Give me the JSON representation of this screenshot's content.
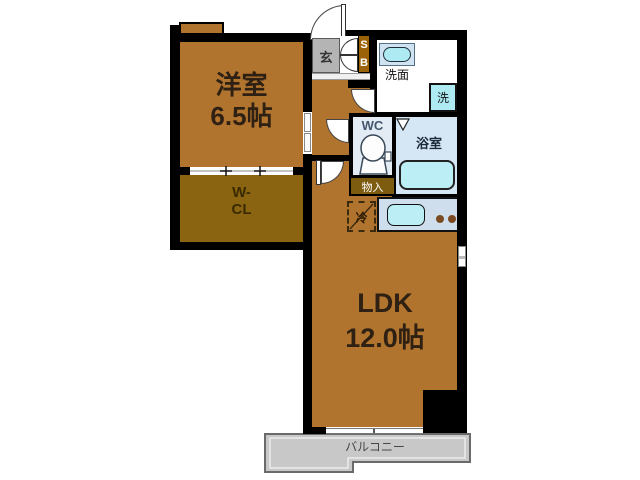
{
  "title": "apartment-floor-plan",
  "rooms": {
    "western": {
      "label": "洋室",
      "size": "6.5帖"
    },
    "wcl": {
      "line1": "W-",
      "line2": "CL"
    },
    "ldk": {
      "label": "LDK",
      "size": "12.0帖"
    },
    "genkan": {
      "label": "玄"
    },
    "shoebox": {
      "letters": [
        "S",
        "B"
      ]
    },
    "washroom": {
      "label": "洗面"
    },
    "washer": {
      "label": "洗"
    },
    "wc": {
      "label": "WC"
    },
    "bath": {
      "label": "浴室"
    },
    "storage": {
      "label": "物入"
    },
    "fridge": {
      "label": "冷"
    },
    "balcony": {
      "label": "バルコニー"
    }
  },
  "colors": {
    "wall": "#000000",
    "room_floor": "#b1742e",
    "closet_floor": "#8a6410",
    "storage_fill": "#7d5c10",
    "shoebox_fill": "#9c6208",
    "genkan_fill": "#b4b4b4",
    "bath_fill": "#d5e7f4",
    "wc_fill": "#e3ecf4",
    "kitchen_fill": "#cfdeed",
    "fixture_cyan": "#aeeaf2",
    "tub_cyan": "#bceef5",
    "balcony_fill": "#c8c8c8",
    "burner_brown": "#7b4a20"
  }
}
